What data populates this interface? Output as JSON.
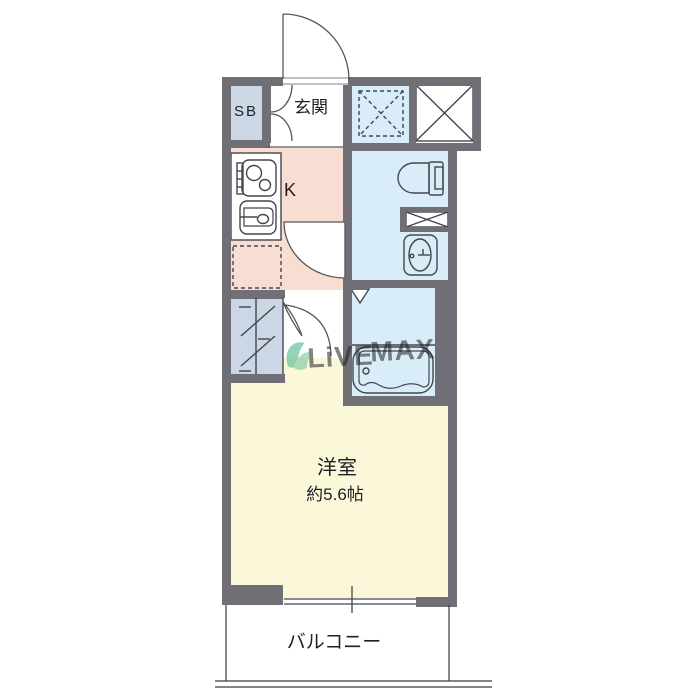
{
  "plan": {
    "type": "japanese-apartment-floorplan",
    "labels": {
      "shoe_box": "SB",
      "entrance": "玄関",
      "kitchen": "K",
      "main_room": "洋室",
      "main_room_size": "約5.6帖",
      "balcony": "バルコニー"
    },
    "rooms": [
      {
        "id": "entrance",
        "name": "玄関"
      },
      {
        "id": "shoe-box",
        "name": "SB"
      },
      {
        "id": "kitchen",
        "name": "K"
      },
      {
        "id": "washroom-toilet",
        "name": "toilet / washroom"
      },
      {
        "id": "bathroom",
        "name": "bathroom"
      },
      {
        "id": "closet",
        "name": "closet"
      },
      {
        "id": "western-room",
        "name": "洋室 約5.6帖"
      },
      {
        "id": "balcony",
        "name": "バルコニー"
      }
    ],
    "fixtures": [
      "entrance-door",
      "shoe-box-double-doors",
      "storage-dashed-box",
      "pipe-space-x-box",
      "gas-stove",
      "kitchen-sink",
      "refrigerator-space",
      "kitchen-door",
      "toilet",
      "washing-machine-space",
      "vanity-sink",
      "bathroom-door-mark",
      "bathtub",
      "closet-hanger",
      "room-door",
      "sliding-window",
      "balcony-rail"
    ],
    "watermark": {
      "brand_left": "LiVE",
      "brand_right": "MAX",
      "logo": "leaf-swoosh"
    },
    "colors": {
      "wall": "#6f6f75",
      "line": "#45464c",
      "kitchen_floor": "#f8ddd2",
      "wet_floor": "#d8edf7",
      "storage_floor": "#ccd7e5",
      "room_floor": "#fbf8da",
      "white": "#ffffff",
      "watermark_green": "#3fae7e",
      "watermark_blue": "#97a2c8"
    }
  }
}
